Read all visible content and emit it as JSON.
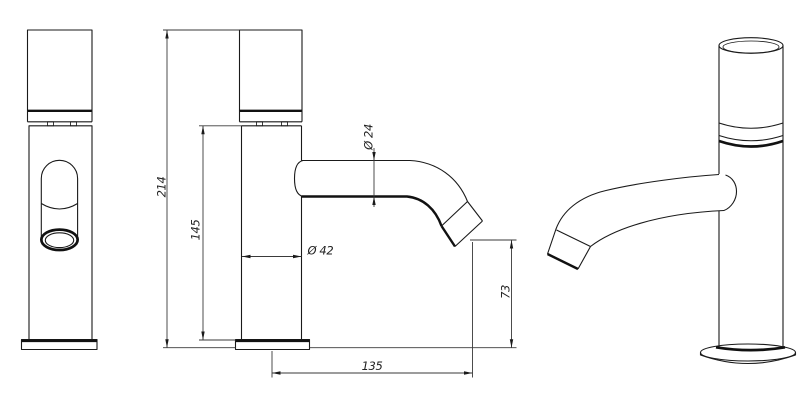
{
  "drawing": {
    "type": "technical-drawing",
    "subject": "single-lever basin faucet",
    "background_color": "#ffffff",
    "line_color": "#1a1a1a",
    "dimension_line_color": "#3a3a3a",
    "labels": {
      "overall_height": "214",
      "body_height": "145",
      "body_diameter": "Ø 42",
      "spout_diameter": "Ø 24",
      "outlet_height": "73",
      "spout_reach": "135"
    }
  }
}
